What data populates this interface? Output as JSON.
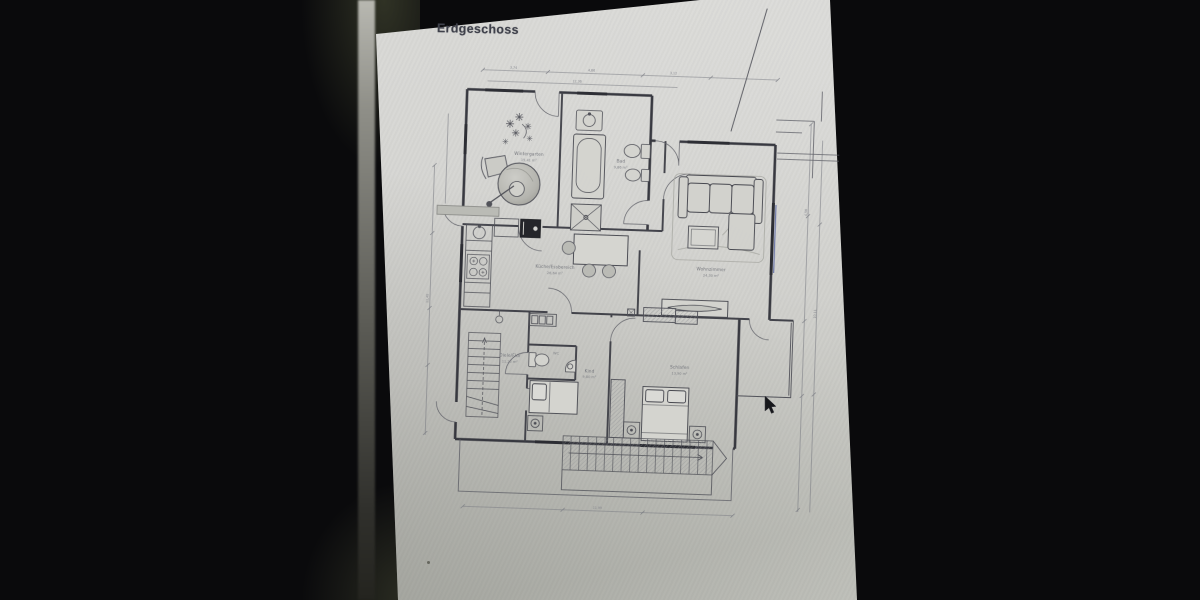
{
  "page": {
    "title": "Erdgeschoss",
    "floor_plan": {
      "rooms": [
        {
          "name": "Wintergarten",
          "area": "15,41 m²"
        },
        {
          "name": "Bad",
          "area": "9,86 m²"
        },
        {
          "name": "Küche/Essbereich",
          "area": "26,64 m²"
        },
        {
          "name": "Wohnzimmer",
          "area": "24,30 m²"
        },
        {
          "name": "Diele/Flur",
          "area": "11,25 m²"
        },
        {
          "name": "WC",
          "area": "2,10 m²"
        },
        {
          "name": "Kind",
          "area": "9,80 m²"
        },
        {
          "name": "Schlafen",
          "area": "13,90 m²"
        }
      ],
      "dimensions": {
        "d1": "3,74",
        "d2": "4,86",
        "d3": "3,12",
        "total_width": "12,36",
        "left": "11,48",
        "right_upper": "4,56",
        "right_total": "10,11",
        "bottom": "11,99"
      },
      "furniture_icons": [
        "plant",
        "armchair",
        "whirlpool",
        "washbasin",
        "bathtub",
        "shower",
        "toilet",
        "bidet",
        "kitchen-counter",
        "sink",
        "cooktop",
        "oven",
        "dining-table",
        "chair",
        "sofa",
        "chaise",
        "coffee-table",
        "sideboard",
        "hall-cabinet",
        "interior-stairs",
        "wc-toilet",
        "wc-sink",
        "single-bed",
        "double-bed",
        "nightstand",
        "wardrobe",
        "closet",
        "exterior-stairs",
        "terrace",
        "canopy"
      ]
    },
    "cursor": "arrow-pointer"
  },
  "colors": {
    "background_bars": "#0a0a0c",
    "page": "#d2d2ce",
    "plan_lines": "#3a3b43",
    "window_accent_blue": "#46549a",
    "title_text": "#3f414b"
  }
}
